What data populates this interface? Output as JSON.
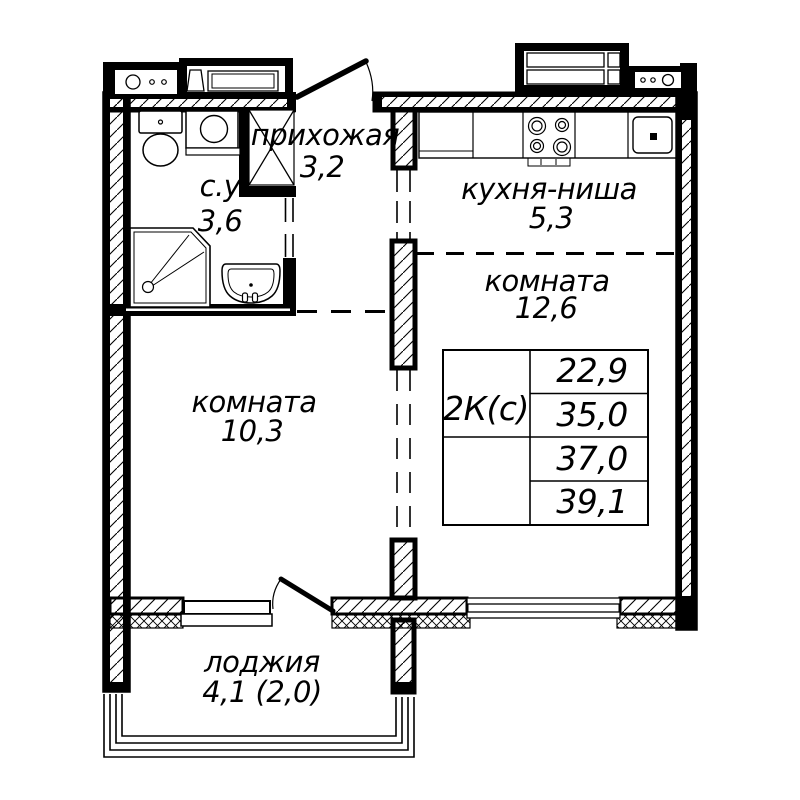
{
  "rooms": [
    {
      "name": "прихожая",
      "area": "3,2"
    },
    {
      "name": "с.у",
      "area": "3,6"
    },
    {
      "name": "кухня-ниша",
      "area": "5,3"
    },
    {
      "name": "комната",
      "area": "12,6"
    },
    {
      "name": "комната",
      "area": "10,3"
    },
    {
      "name": "лоджия",
      "area": "4,1 (2,0)"
    }
  ],
  "info_table": {
    "type_label": "2К(с)",
    "areas": [
      "22,9",
      "35,0",
      "37,0",
      "39,1"
    ]
  },
  "colors": {
    "line": "#000000",
    "background": "#ffffff"
  }
}
